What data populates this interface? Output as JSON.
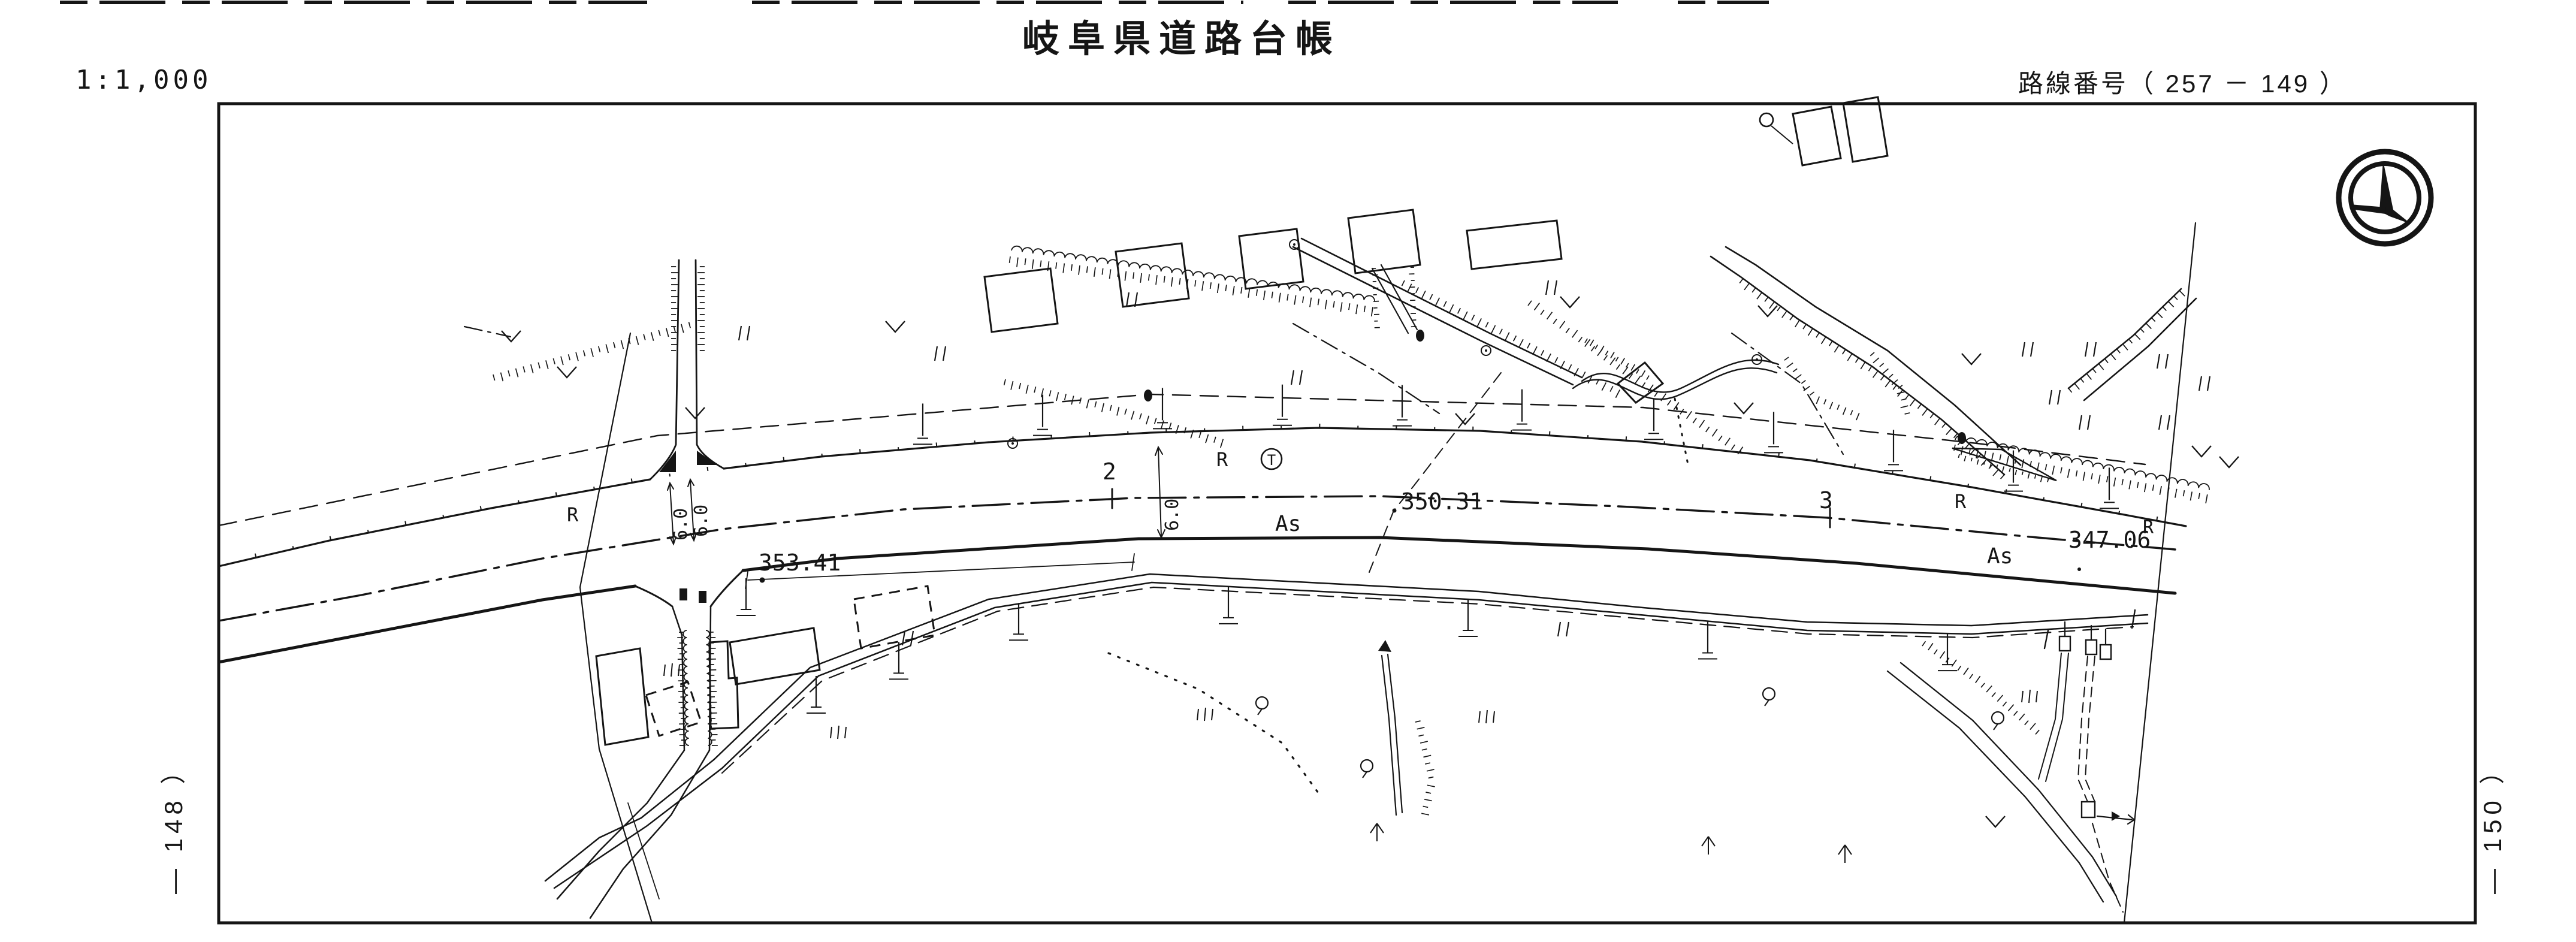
{
  "document": {
    "scale": "1:1,000",
    "title": "岐阜県道路台帳",
    "route_number": "路線番号（ 257 － 149 ）",
    "adjacent_sheet_left": "— 148 ）",
    "adjacent_sheet_right": "— 150 ）"
  },
  "map": {
    "spot_elevation_left": "353.41",
    "spot_elevation_center": "350.31",
    "spot_elevation_right": "347.06",
    "spot_elevation_right_suffix": "R",
    "pavement_label": "As",
    "curve_point_label": "R",
    "station_2": "2",
    "station_3": "3",
    "road_width": "6.0",
    "pole_symbol_letter": "T"
  },
  "colors": {
    "ink": "#151515",
    "paper": "#ffffff"
  }
}
